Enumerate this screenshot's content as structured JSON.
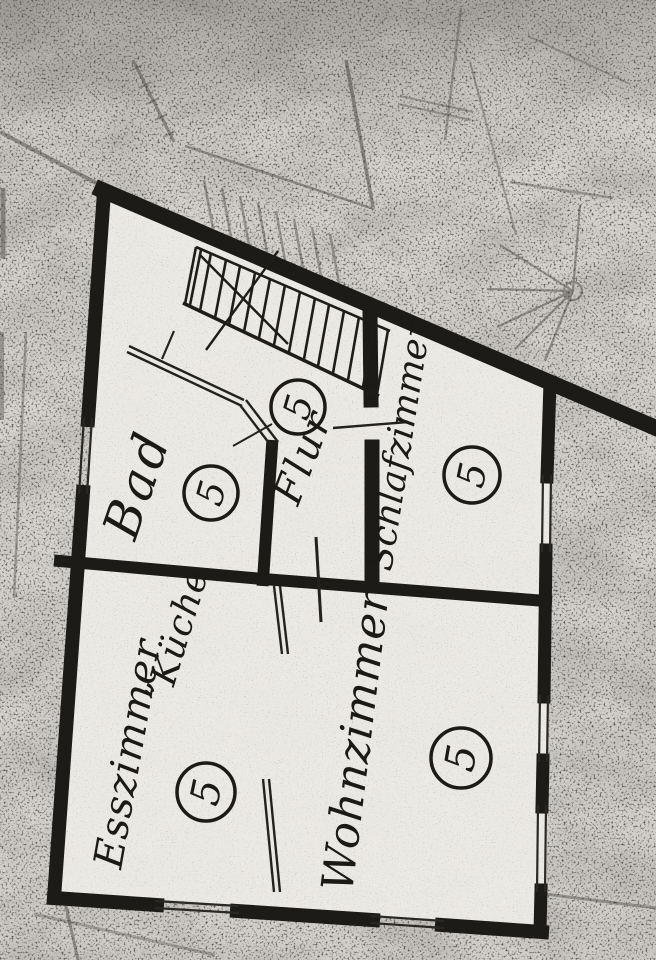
{
  "plan": {
    "rooms": [
      {
        "label": "Bad"
      },
      {
        "label": "Flur"
      },
      {
        "label": "Schlafzimmer"
      },
      {
        "label": "Esszimmer"
      },
      {
        "label": "”Küche"
      },
      {
        "label": "Wohnzimmer"
      }
    ],
    "unit_numbers": [
      "5",
      "5",
      "5",
      "5",
      "5"
    ],
    "colors": {
      "ink": "#1d1b17",
      "paper": "#d6d3cd",
      "room_fill": "#edebe6",
      "faint_ink": "#4b4843"
    }
  }
}
